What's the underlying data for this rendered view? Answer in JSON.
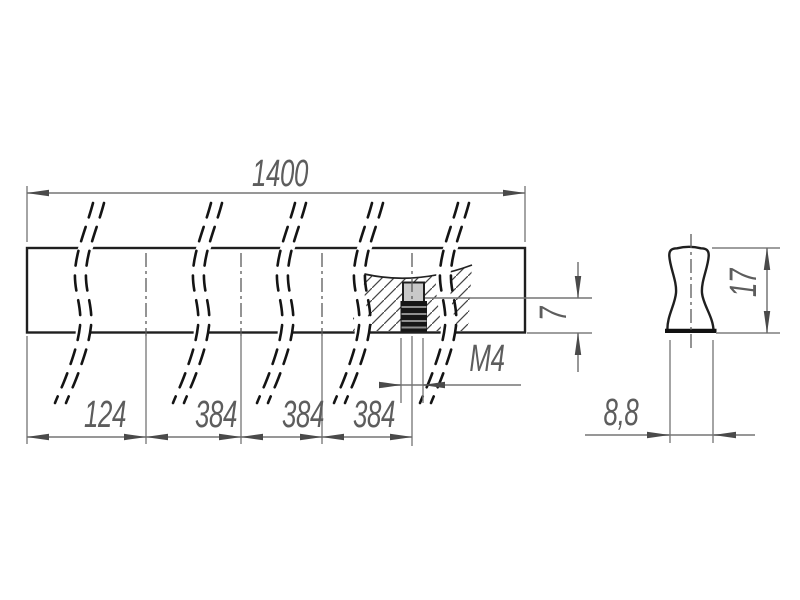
{
  "drawing": {
    "views": {
      "front": {
        "overall_length": "1400",
        "hole_spacings": [
          "124",
          "384",
          "384",
          "384"
        ],
        "thread_label": "M4",
        "thread_depth": "7"
      },
      "side": {
        "profile_height": "17",
        "profile_width": "8,8"
      }
    },
    "colors": {
      "background": "#ffffff",
      "part_fill": "#a9a9a9",
      "hole_fill": "#c9c9c9",
      "outline": "#1f1f1f",
      "dimension_line": "#757575",
      "text": "#5d5d5d"
    }
  }
}
